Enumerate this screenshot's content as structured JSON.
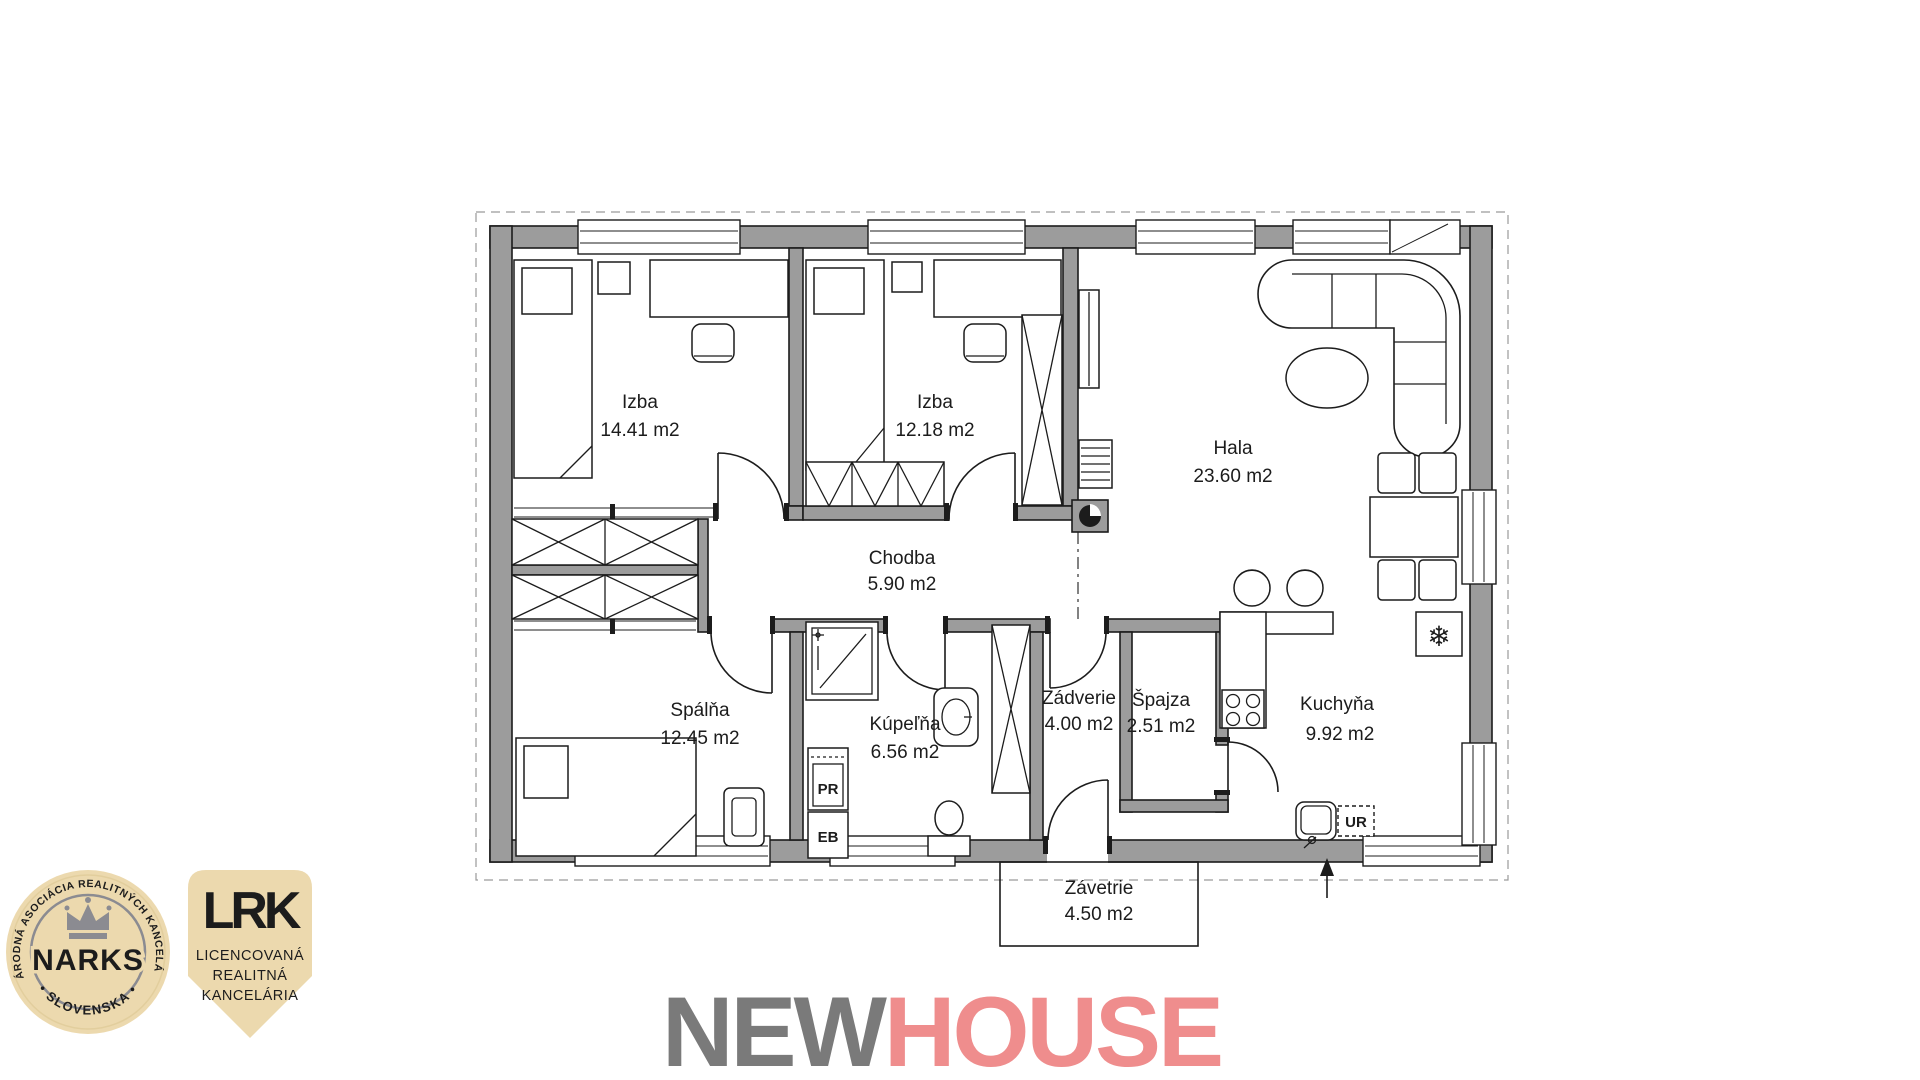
{
  "floor_plan": {
    "rooms": [
      {
        "name": "Izba",
        "area": "14.41 m2"
      },
      {
        "name": "Izba",
        "area": "12.18 m2"
      },
      {
        "name": "Hala",
        "area": "23.60 m2"
      },
      {
        "name": "Chodba",
        "area": "5.90 m2"
      },
      {
        "name": "Spálňa",
        "area": "12.45 m2"
      },
      {
        "name": "Kúpeľňa",
        "area": "6.56 m2"
      },
      {
        "name": "Zádverie",
        "area": "4.00 m2"
      },
      {
        "name": "Špajza",
        "area": "2.51 m2"
      },
      {
        "name": "Kuchyňa",
        "area": "9.92 m2"
      },
      {
        "name": "Závetrie",
        "area": "4.50 m2"
      }
    ],
    "appliances": {
      "washing_machine": "PR",
      "boiler": "EB",
      "dishwasher": "UR",
      "fridge_symbol": "❄"
    },
    "colors": {
      "wall": "#9c9c9c",
      "line": "#1c1c1c"
    }
  },
  "narks_badge": {
    "ring_text": "NÁRODNÁ ASOCIÁCIA REALITNÝCH KANCELÁRIÍ",
    "name": "NARKS",
    "country": "• SLOVENSKA •",
    "beige": "#ecd9ae",
    "gray": "#8b8b91"
  },
  "lrk_badge": {
    "initials": "LRK",
    "line1": "LICENCOVANÁ",
    "line2": "REALITNÁ",
    "line3": "KANCELÁRIA"
  },
  "brand": {
    "new": "NEW",
    "house": "HOUSE",
    "new_color": "#7a7a7a",
    "house_color": "#ef8d8d"
  }
}
